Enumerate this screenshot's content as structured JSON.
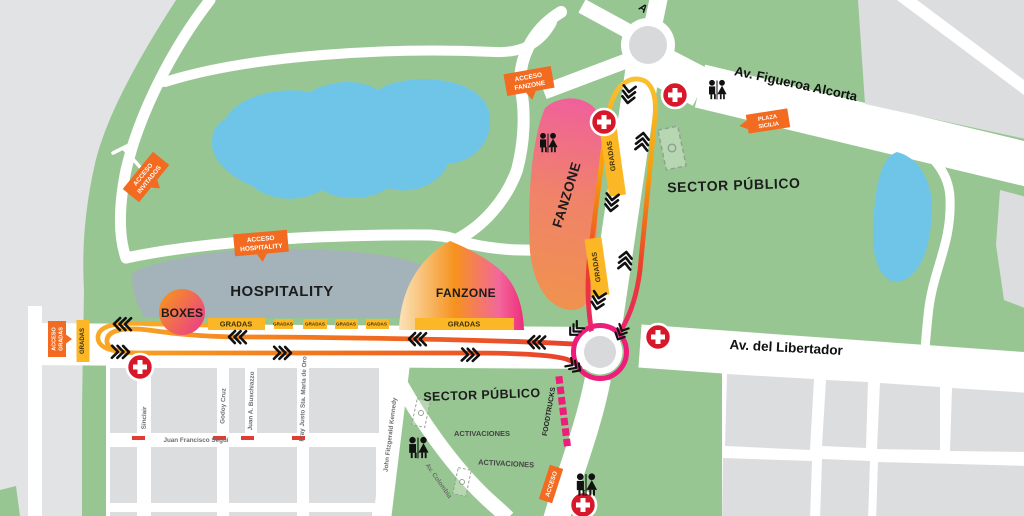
{
  "map": {
    "zones": {
      "hospitality": "HOSPITALITY",
      "fanzone_upper": "FANZONE",
      "fanzone_lower": "FANZONE",
      "boxes": "BOXES",
      "sector_publico_north": "SECTOR PÚBLICO",
      "sector_publico_south": "SECTOR PÚBLICO",
      "activaciones_a": "ACTIVACIONES",
      "activaciones_b": "ACTIVACIONES",
      "foodtrucks": "FOODTRUCKS",
      "gradas": "GRADAS"
    },
    "streets": {
      "figueroa_alcorta": "Av. Figueroa Alcorta",
      "libertador": "Av. del Libertador",
      "sinclair": "Sinclair",
      "godoy_cruz": "Godoy Cruz",
      "buschiazzo": "Juan A. Buschiazzo",
      "fray_justo": "Fray Justo Sta. Maria de Oro",
      "kennedy": "John Fitzgerald Kennedy",
      "segui": "Juan Francisco Seguí",
      "colombia": "Av. Colombia",
      "top_partial": "A"
    },
    "access_tags": {
      "acceso_invitados_l1": "ACCESO",
      "acceso_invitados_l2": "INVITADOS",
      "acceso_hospitality_l1": "ACCESO",
      "acceso_hospitality_l2": "HOSPITALITY",
      "acceso_fanzone_l1": "ACCESO",
      "acceso_fanzone_l2": "FANZONE",
      "acceso_gradas_l1": "ACCESO",
      "acceso_gradas_l2": "GRADAS",
      "plaza_sicilia_l1": "PLAZA",
      "plaza_sicilia_l2": "SICILIA",
      "acceso_south": "ACCESO"
    },
    "colors": {
      "park_green": "#98C693",
      "lake_blue": "#6FC5E8",
      "city_gray": "#E2E3E4",
      "block_gray": "#DCDDDE",
      "road_white": "#FFFFFF",
      "hospitality_gray": "#A4B2BA",
      "gradas_yellow": "#FBB725",
      "tag_orange": "#F26B21",
      "track_orange": "#F9A825",
      "track_red": "#E8402E",
      "track_pink": "#EC1E79",
      "medical_red": "#D7182A"
    }
  }
}
